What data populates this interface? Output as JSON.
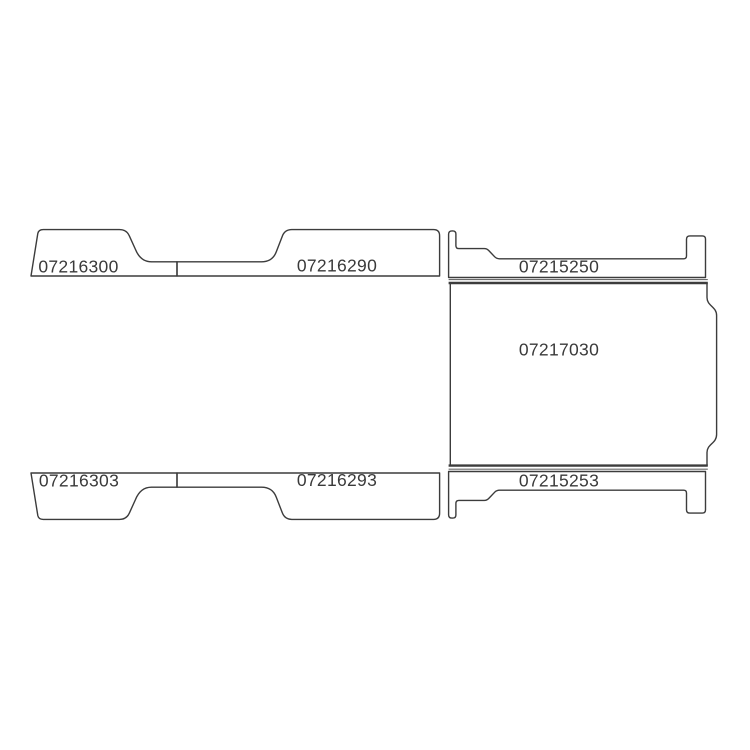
{
  "diagram": {
    "background_color": "#ffffff",
    "line_color": "#3c3c3c",
    "panels": [
      {
        "id": "top-left-panel",
        "part_number": "07216300"
      },
      {
        "id": "top-middle-panel",
        "part_number": "07216290"
      },
      {
        "id": "top-right-panel",
        "part_number": "07215250"
      },
      {
        "id": "center-floor-panel",
        "part_number": "07217030"
      },
      {
        "id": "bottom-left-panel",
        "part_number": "07216303"
      },
      {
        "id": "bottom-middle-panel",
        "part_number": "07216293"
      },
      {
        "id": "bottom-right-panel",
        "part_number": "07215253"
      }
    ]
  }
}
